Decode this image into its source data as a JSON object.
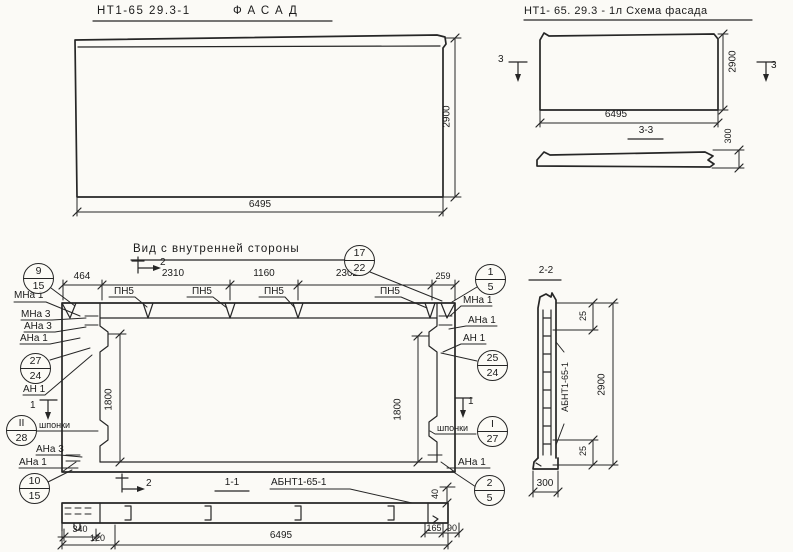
{
  "facade": {
    "code": "НТ1-65 29.3-1",
    "name": "ФАСАД",
    "width": "6495",
    "height": "2900"
  },
  "scheme": {
    "title": "НТ1- 65. 29.3 - 1л  Схема фасада",
    "width": "6495",
    "height": "2900",
    "marker": "3",
    "section_title": "3-3",
    "thickness": "300"
  },
  "interior": {
    "title": "Вид с внутренней стороны",
    "dims_top": [
      "464",
      "2310",
      "1160",
      "2302",
      "259"
    ],
    "dim_vertical": "1800",
    "pn5": "ПН5",
    "marker_2": "2",
    "marker_1": "1",
    "shponki": "шпонки",
    "labels": {
      "mna1": "МНа 1",
      "mna3": "МНа 3",
      "ana3": "АНа 3",
      "ana1": "АНа 1",
      "an1": "АН 1"
    },
    "callouts": {
      "c17_22": {
        "top": "17",
        "bottom": "22"
      },
      "c9_15": {
        "top": "9",
        "bottom": "15"
      },
      "c27_24": {
        "top": "27",
        "bottom": "24"
      },
      "cII_28": {
        "top": "II",
        "bottom": "28"
      },
      "c10_15": {
        "top": "10",
        "bottom": "15"
      },
      "c1_5": {
        "top": "1",
        "bottom": "5"
      },
      "c25_24": {
        "top": "25",
        "bottom": "24"
      },
      "cI_27": {
        "top": "I",
        "bottom": "27"
      },
      "c2_5": {
        "top": "2",
        "bottom": "5"
      }
    }
  },
  "section11": {
    "title": "1-1",
    "abnt": "АБНТ1-65-1",
    "dims": {
      "a": "340",
      "b": "120",
      "total": "6495",
      "c": "40",
      "d": "165",
      "e": "90"
    }
  },
  "section22": {
    "title": "2-2",
    "abnt": "АБНТ1-65-1",
    "dims": {
      "cover_top": "25",
      "height": "2900",
      "cover_bottom": "25",
      "width": "300"
    }
  }
}
